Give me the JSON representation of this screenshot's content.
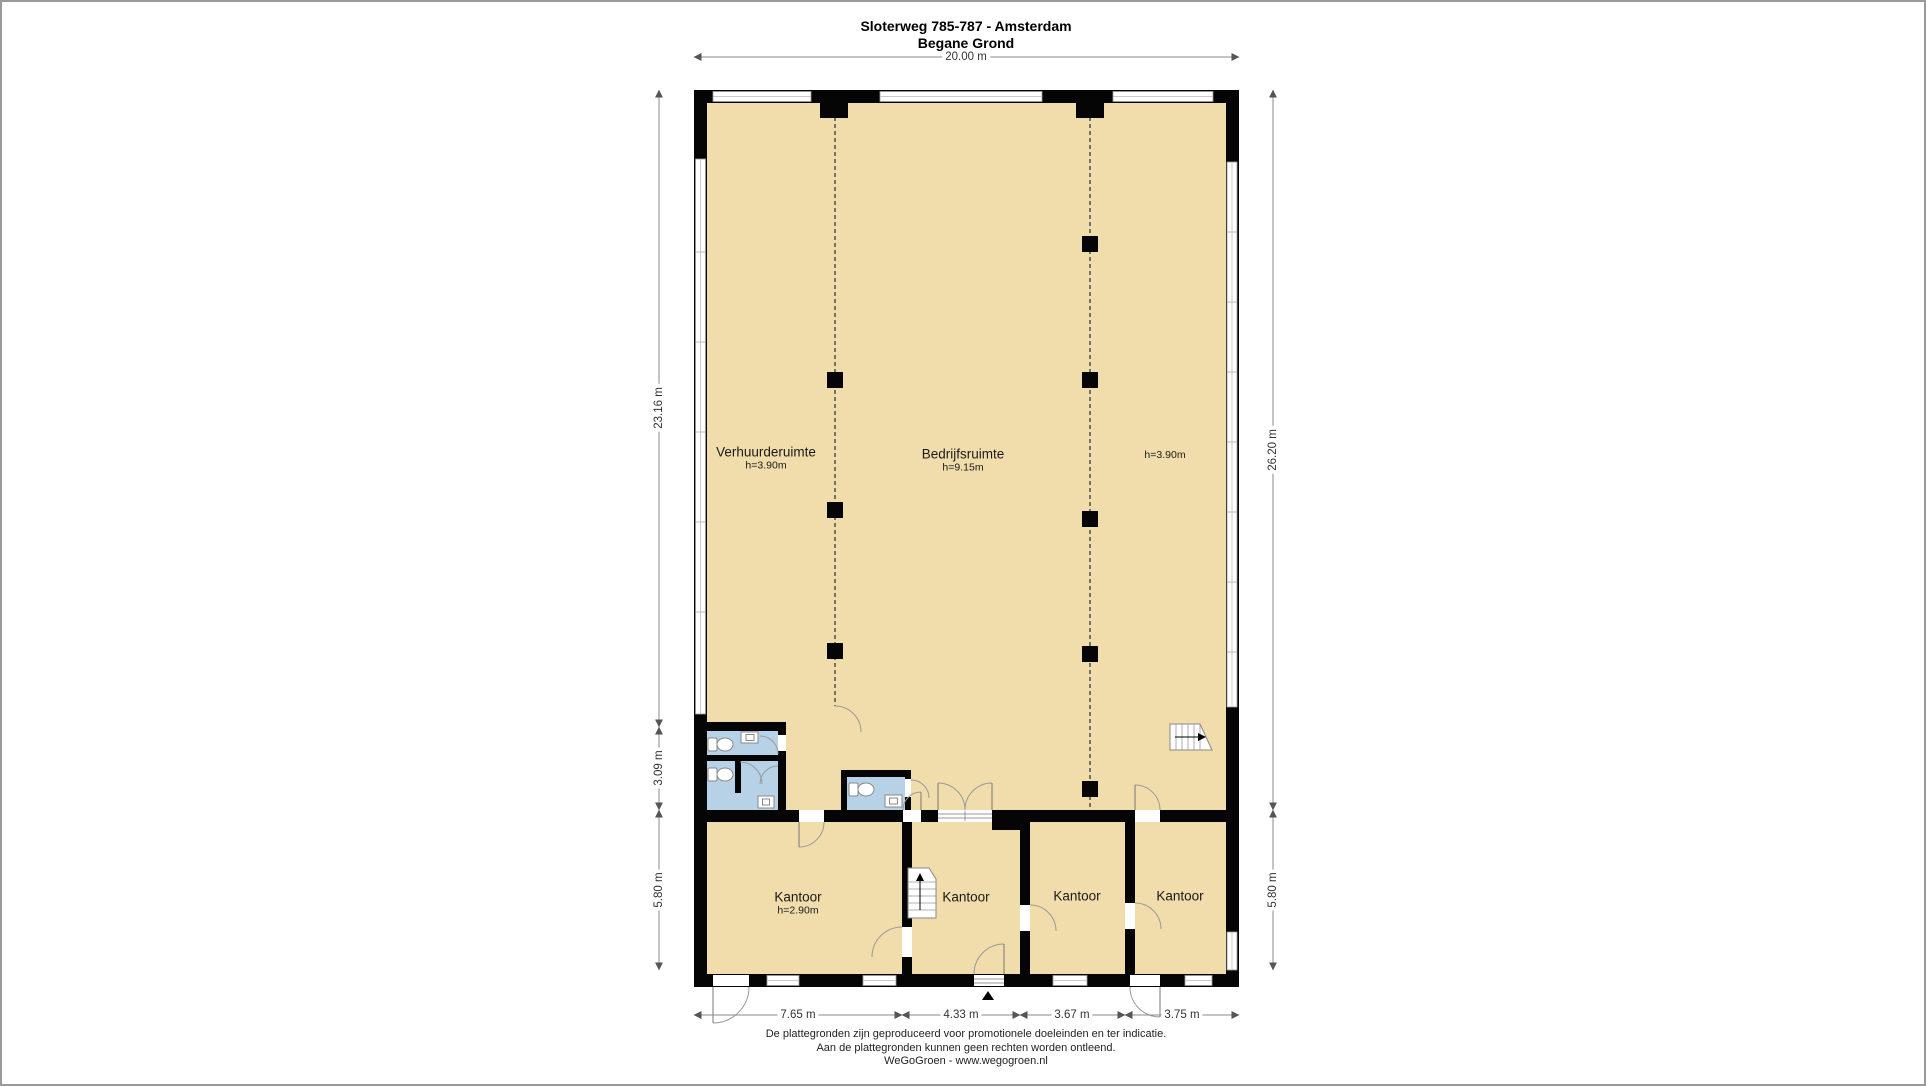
{
  "title": {
    "line1": "Sloterweg 785-787 - Amsterdam",
    "line2": "Begane Grond"
  },
  "hall_rooms": [
    {
      "label": "Verhuurderuimte",
      "height": "h=3.90m"
    },
    {
      "label": "Bedrijfsruimte",
      "height": "h=9.15m"
    },
    {
      "label": "",
      "height": "h=3.90m"
    }
  ],
  "offices": [
    {
      "label": "Kantoor",
      "height": "h=2.90m"
    },
    {
      "label": "Kantoor",
      "height": ""
    },
    {
      "label": "Kantoor",
      "height": ""
    },
    {
      "label": "Kantoor",
      "height": ""
    }
  ],
  "dimensions": {
    "top_width": "20.00 m",
    "left_upper": "23.16 m",
    "left_middle": "3.09 m",
    "left_lower": "5.80 m",
    "right_upper": "26.20 m",
    "right_lower": "5.80 m",
    "bottom": [
      "7.65 m",
      "4.33 m",
      "3.67 m",
      "3.75 m"
    ]
  },
  "footer": {
    "line1": "De plattegronden zijn geproduceerd voor promotionele doeleinden en ter indicatie.",
    "line2": "Aan de plattegronden kunnen geen rechten worden ontleend.",
    "line3": "WeGoGroen -  www.wegogroen.nl"
  },
  "colors": {
    "floor": "#f0ddab",
    "wet_room": "#b7d2e6",
    "wall": "#000000",
    "window": "#ffffff",
    "dimension_line": "#888888"
  }
}
